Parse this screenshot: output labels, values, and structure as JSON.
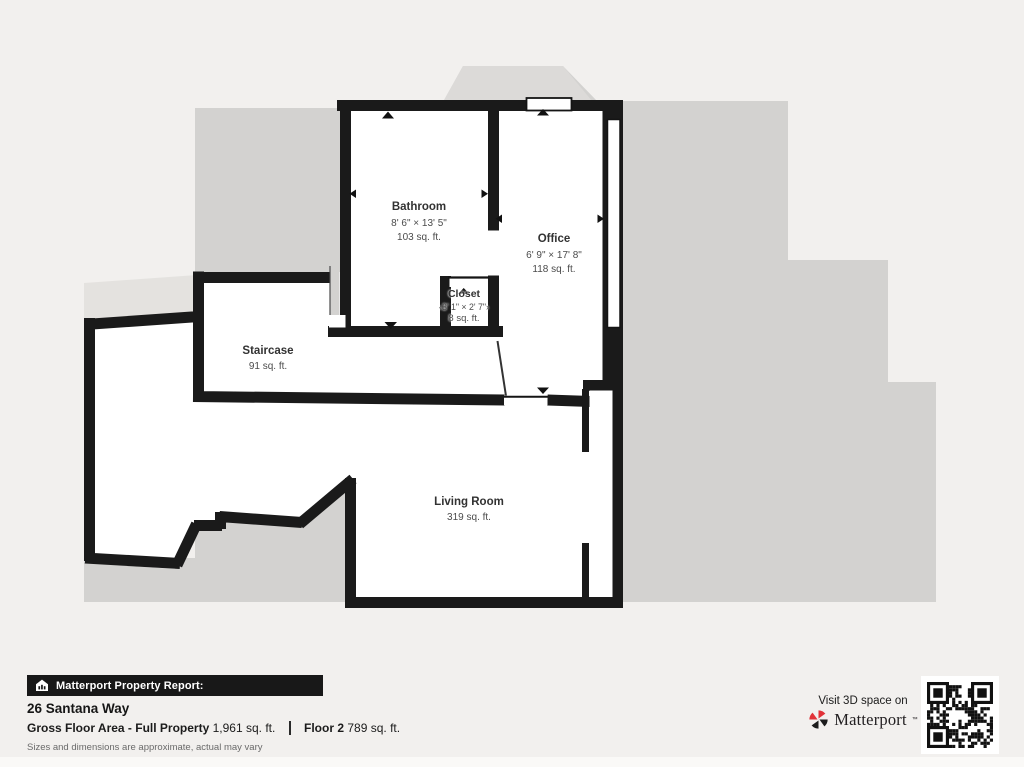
{
  "colors": {
    "page_bg": "#f2f0ee",
    "underlay": "#d3d2d0",
    "underlay_light": "#e4e2df",
    "underlay_bump": "#dcdad8",
    "wall": "#1a1a1a",
    "brand_red": "#e13238",
    "qr_dark": "#111111"
  },
  "floor_plan": {
    "rooms": [
      {
        "id": "bathroom",
        "name": "Bathroom",
        "dims": "8' 6\" × 13' 5\"",
        "area": "103 sq. ft."
      },
      {
        "id": "office",
        "name": "Office",
        "dims": "6' 9\" × 17' 8\"",
        "area": "118 sq. ft."
      },
      {
        "id": "closet",
        "name": "Closet",
        "dims": "‹3' 1\" × 2' 7\"›",
        "area": "8 sq. ft."
      },
      {
        "id": "staircase",
        "name": "Staircase",
        "dims": "",
        "area": "91 sq. ft."
      },
      {
        "id": "living-room",
        "name": "Living Room",
        "dims": "",
        "area": "319 sq. ft."
      }
    ]
  },
  "footer": {
    "report_label": "Matterport Property Report:",
    "address": "26 Santana Way",
    "gfa_label": "Gross Floor Area - Full Property",
    "gfa_value": "1,961 sq. ft.",
    "floor_label": "Floor 2",
    "floor_value": "789 sq. ft.",
    "disclaimer": "Sizes and dimensions are approximate, actual may vary",
    "visit_label": "Visit 3D space on",
    "brand_name": "Matterport",
    "brand_tm": "™"
  }
}
